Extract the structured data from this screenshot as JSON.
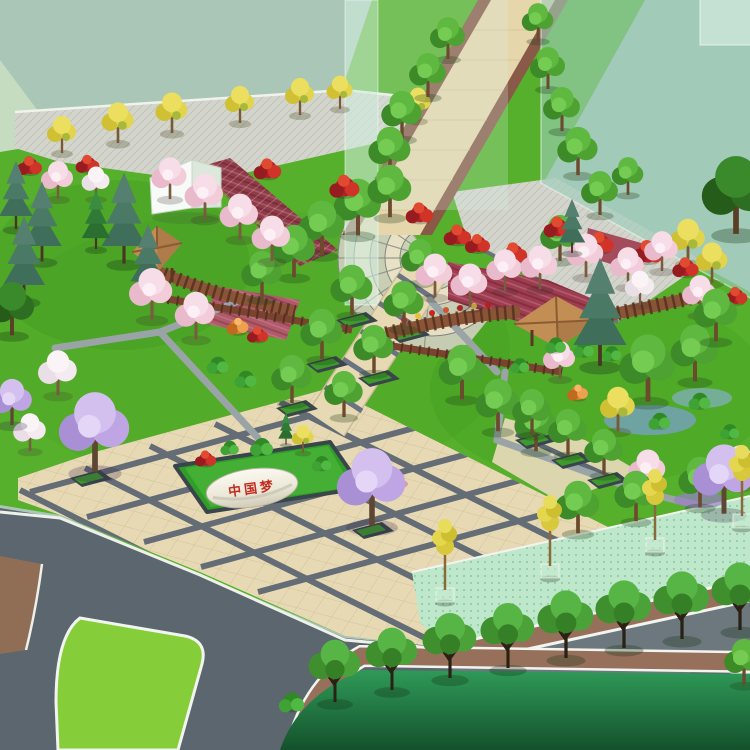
{
  "scene": {
    "type": "aerial-landscape-architecture-rendering",
    "description": "Bird's-eye 3D rendering of a park entrance plaza with pergolas, monument stone, roads and greenway",
    "monument": {
      "text": "中国梦"
    }
  },
  "palette": {
    "sky_ground": "#a9c6b6",
    "glass_building": "#9ecaba",
    "lawn": "#56b02c",
    "lawn_dark": "#1f6a3a",
    "plaza_paving": "#e8d9b5",
    "plaza_grid": "#5d6772",
    "walk_paving": "#d3d5cc",
    "main_road": "#e6d6ac",
    "road_edge_brown": "#8a5a48",
    "asphalt": "#5c666e",
    "greenway": "#bfe7cb",
    "sidewalk_brown": "#97705c",
    "median_lawn": "#86cd3a",
    "pergola_wood": "#7a4330",
    "gazebo_roof": "#c28e54",
    "stone": "#f0ede2",
    "monument_text": "#c42b20"
  }
}
